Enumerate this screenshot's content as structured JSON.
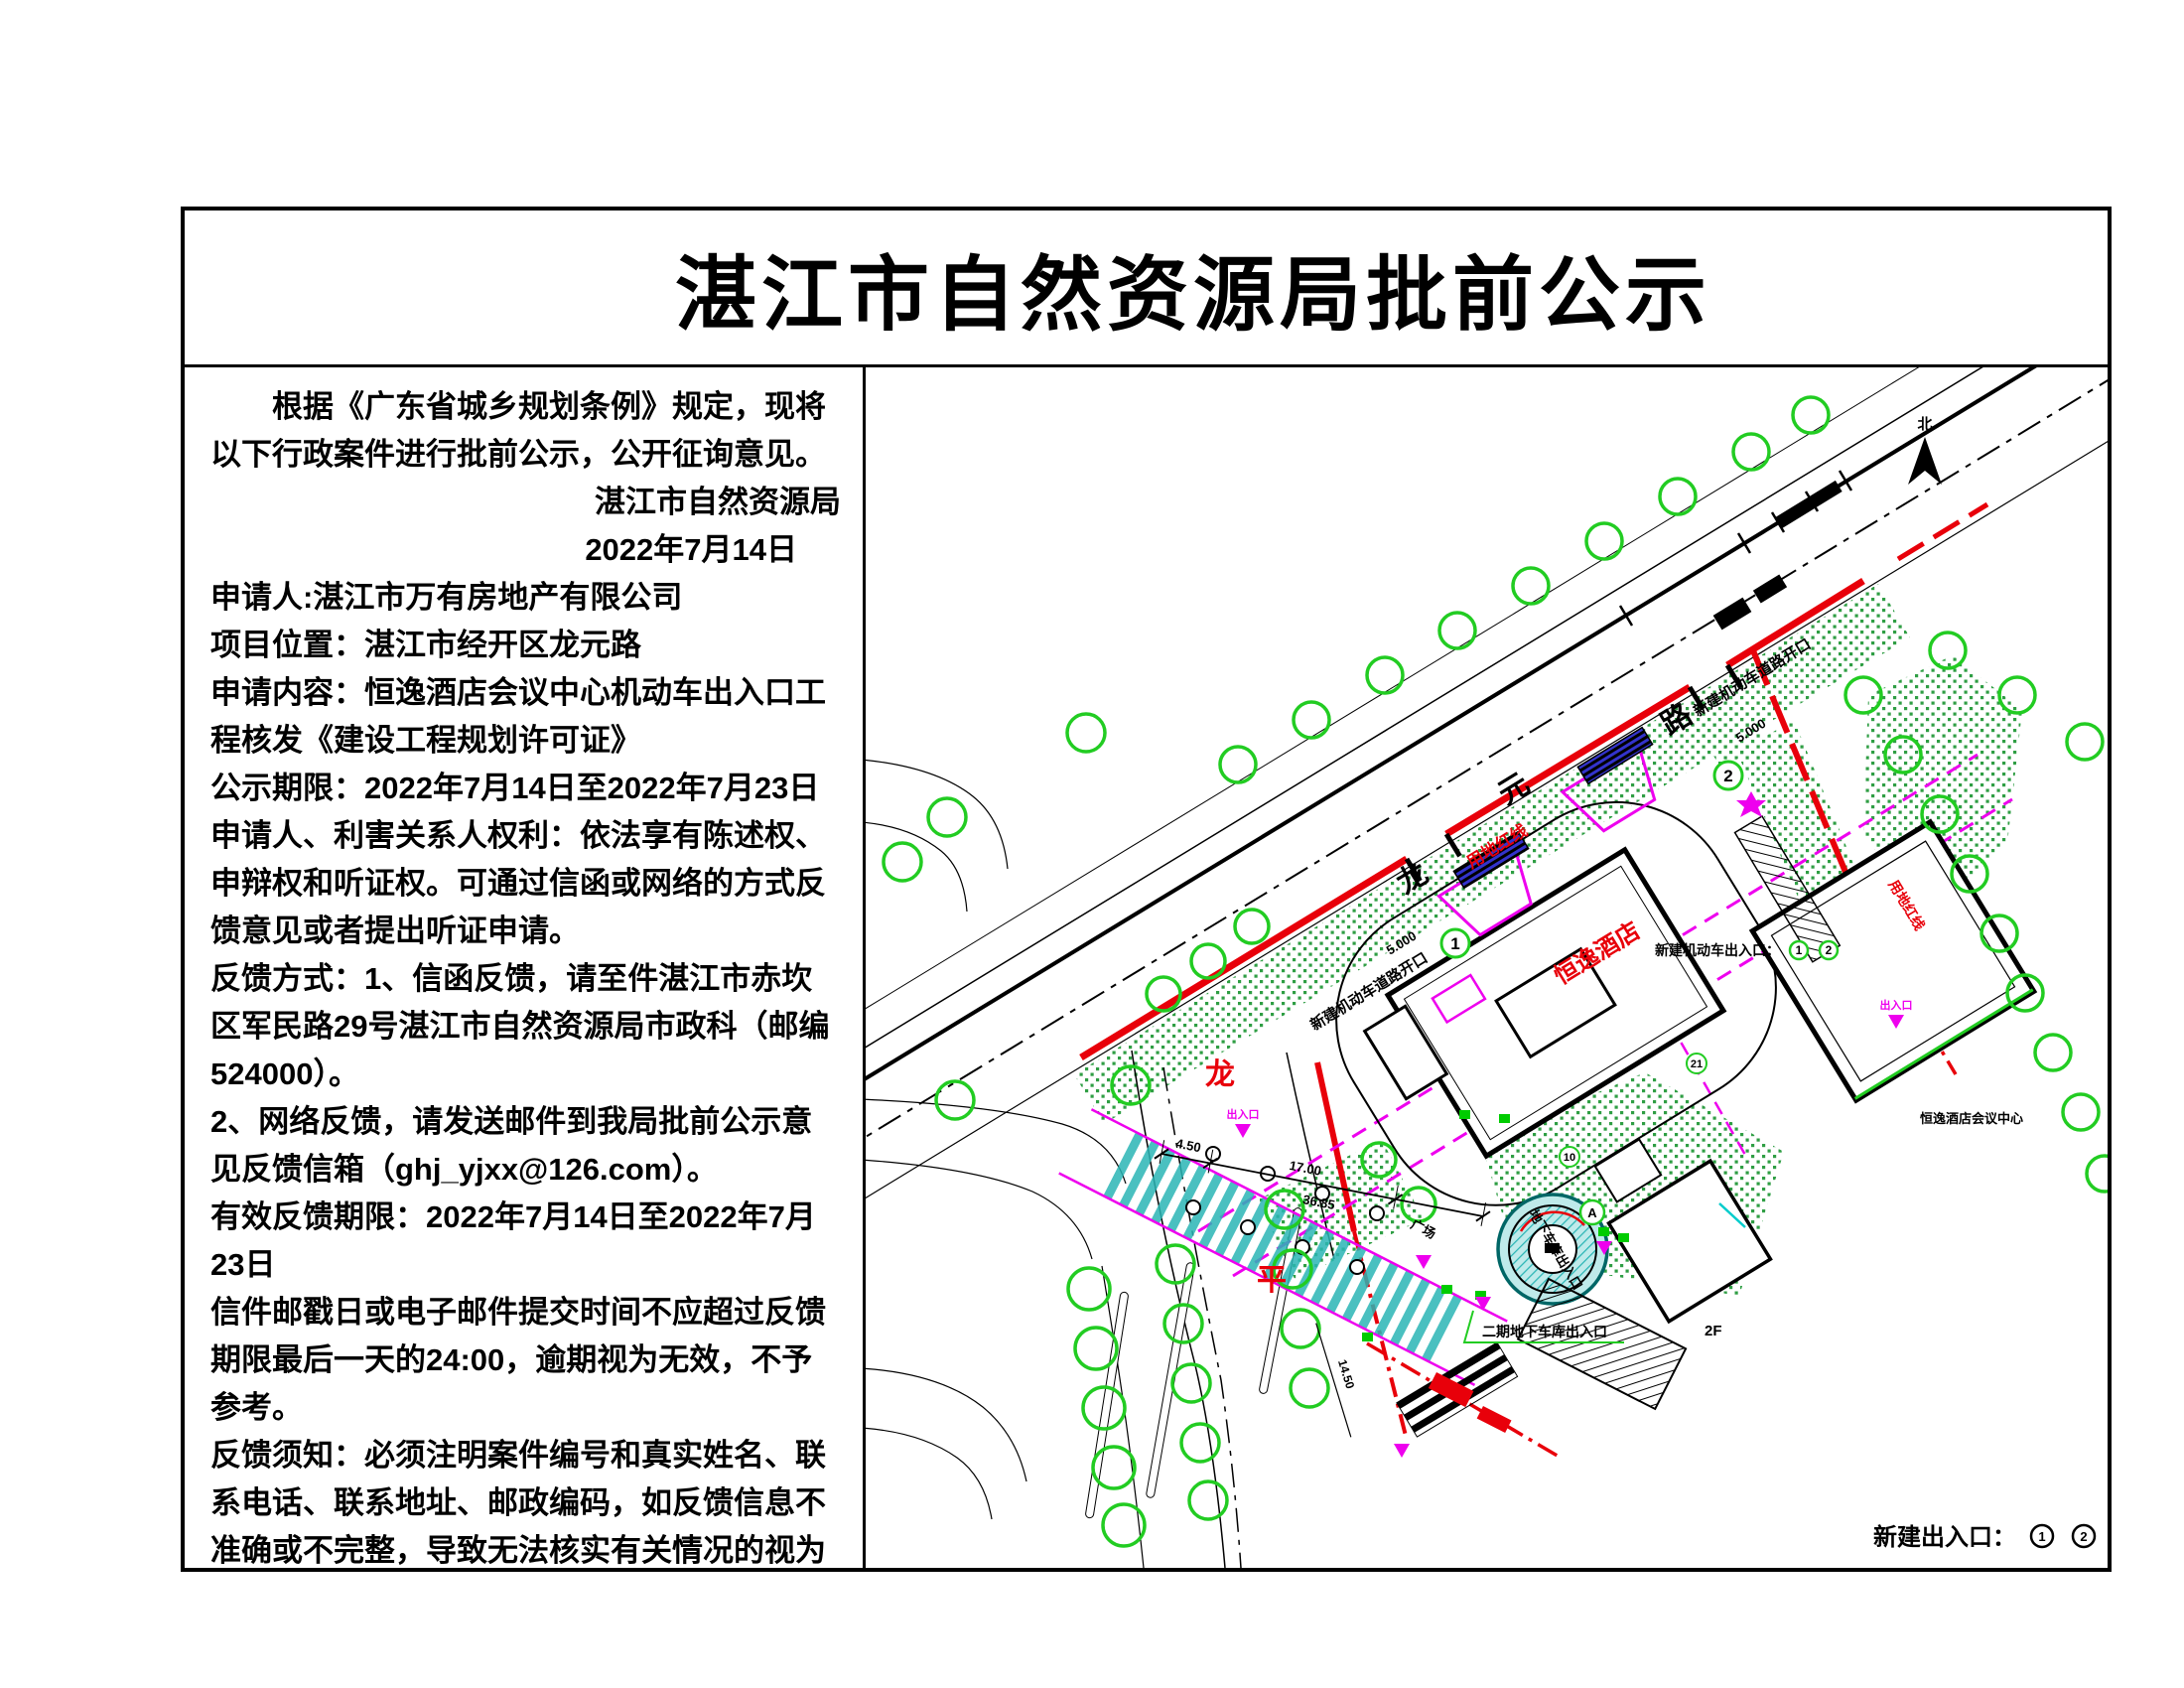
{
  "title": "湛江市自然资源局批前公示",
  "notice": {
    "intro": "根据《广东省城乡规划条例》规定，现将以下行政案件进行批前公示，公开征询意见。",
    "signature_org": "湛江市自然资源局",
    "signature_date": "2022年7月14日",
    "applicant": "申请人:湛江市万有房地产有限公司",
    "location": "项目位置：湛江市经开区龙元路",
    "request": "申请内容：恒逸酒店会议中心机动车出入口工程核发《建设工程规划许可证》",
    "period": "公示期限：2022年7月14日至2022年7月23日",
    "rights": "申请人、利害关系人权利：依法享有陈述权、申辩权和听证权。可通过信函或网络的方式反馈意见或者提出听证申请。",
    "feedback_mail": "反馈方式：1、信函反馈，请至件湛江市赤坎区军民路29号湛江市自然资源局市政科（邮编524000）。",
    "feedback_net": "2、网络反馈，请发送邮件到我局批前公示意见反馈信箱（ghj_yjxx@126.com）。",
    "valid_period": "有效反馈期限：2022年7月14日至2022年7月23日",
    "deadline_note": "信件邮戳日或电子邮件提交时间不应超过反馈期限最后一天的24:00，逾期视为无效，不予参考。",
    "require_note": "反馈须知：必须注明案件编号和真实姓名、联系电话、联系地址、邮政编码，如反馈信息不准确或不完整，导致无法核实有关情况的视为无效。"
  },
  "map": {
    "north_label": "北",
    "road_name": [
      "龙",
      "元",
      "路"
    ],
    "cross_road_name": [
      "龙",
      "平"
    ],
    "red_line_label": "用地红线",
    "red_line_label_east": "用地红线",
    "hotel_label": "恒逸酒店",
    "hotel_center_label": "恒逸酒店会议中心",
    "entrance_note_label": "新建机动车出入口：",
    "entrance_no_1": "1",
    "entrance_no_2": "2",
    "road_opening_label": "新建机动车道路开口",
    "opening_width": "5.000",
    "plaza_label": "广场",
    "garage_label": "地下车库出入口",
    "garage_phase_label": "二期地下车库出入口",
    "floor_label": "2F",
    "marker_a": "A",
    "marker_10": "10",
    "marker_21": "21",
    "pedestrian_label": "出入口",
    "dims": {
      "d1": "4.50",
      "d2": "17.00",
      "d3": "36.85",
      "d4": "14.50"
    },
    "legend_label": "新建出入口：",
    "colors": {
      "boundary_red": "#e8000a",
      "tree_green": "#22cc22",
      "planting_green": "#2f9e44",
      "magenta": "#ee00ee",
      "teal": "#2ab5b5"
    }
  }
}
